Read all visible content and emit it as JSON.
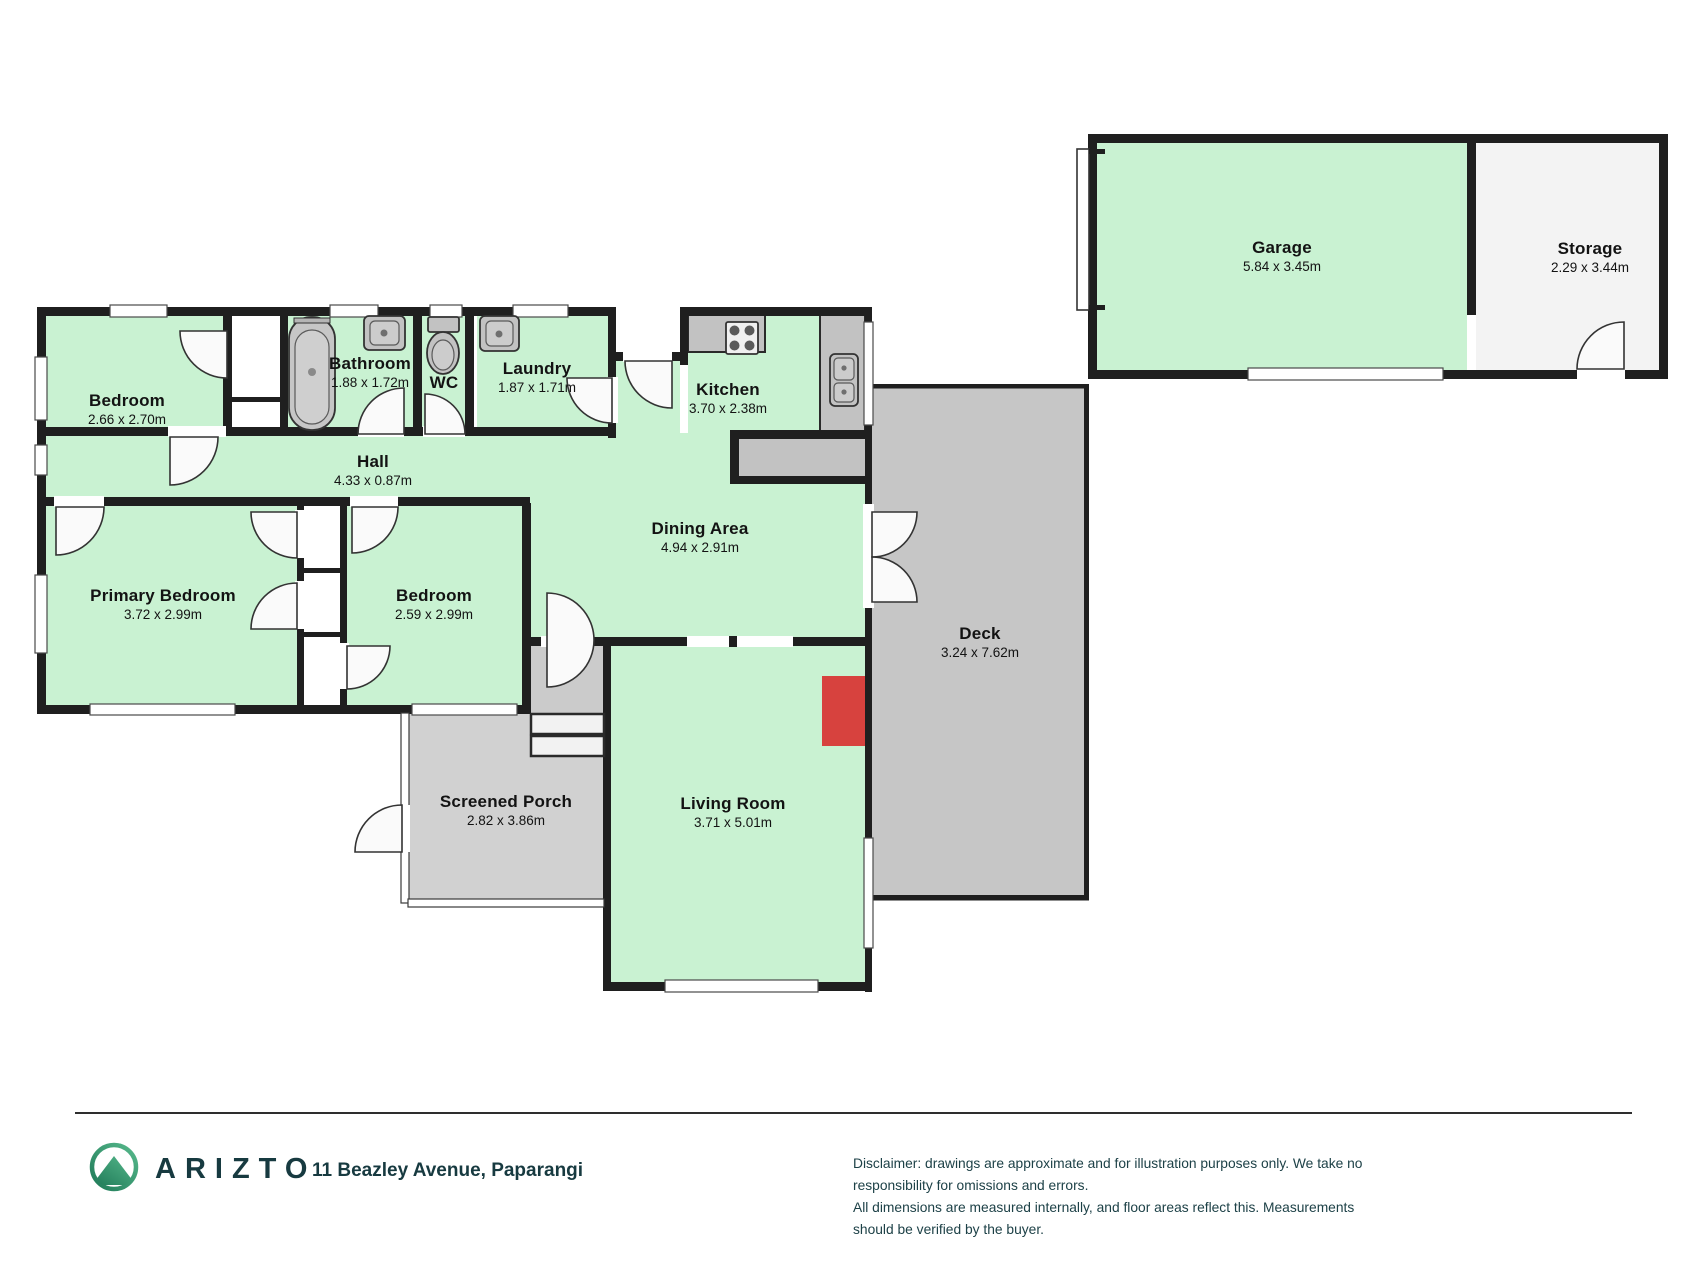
{
  "brand": "ARIZTO",
  "address": "11 Beazley Avenue, Paparangi",
  "disclaimer_line1": "Disclaimer: drawings are approximate and for illustration purposes only. We take no responsibility for omissions and errors.",
  "disclaimer_line2": "All dimensions are measured internally, and floor areas reflect this. Measurements should be verified by the buyer.",
  "colors": {
    "room_green": "#c9f2d2",
    "deck_gray": "#c6c6c6",
    "porch_gray": "#d1d1d1",
    "counter_gray": "#c2c2c2",
    "storage_gray": "#f3f3f3",
    "wall": "#1f1f1f",
    "fireplace_red": "#d7423e",
    "brand_navy": "#173a40",
    "logo_green_light": "#57b98c",
    "logo_green_dark": "#1f7a58"
  },
  "rooms": [
    {
      "id": "bedroom-1",
      "name": "Bedroom",
      "dims": "2.66 x 2.70m"
    },
    {
      "id": "bathroom",
      "name": "Bathroom",
      "dims": "1.88 x 1.72m"
    },
    {
      "id": "wc",
      "name": "WC",
      "dims": ""
    },
    {
      "id": "laundry",
      "name": "Laundry",
      "dims": "1.87 x 1.71m"
    },
    {
      "id": "kitchen",
      "name": "Kitchen",
      "dims": "3.70 x 2.38m"
    },
    {
      "id": "hall",
      "name": "Hall",
      "dims": "4.33 x 0.87m"
    },
    {
      "id": "dining-area",
      "name": "Dining Area",
      "dims": "4.94 x 2.91m"
    },
    {
      "id": "primary-bedroom",
      "name": "Primary Bedroom",
      "dims": "3.72 x 2.99m"
    },
    {
      "id": "bedroom-2",
      "name": "Bedroom",
      "dims": "2.59 x 2.99m"
    },
    {
      "id": "deck",
      "name": "Deck",
      "dims": "3.24 x 7.62m"
    },
    {
      "id": "screened-porch",
      "name": "Screened Porch",
      "dims": "2.82 x 3.86m"
    },
    {
      "id": "living-room",
      "name": "Living Room",
      "dims": "3.71 x 5.01m"
    },
    {
      "id": "garage",
      "name": "Garage",
      "dims": "5.84 x 3.45m"
    },
    {
      "id": "storage",
      "name": "Storage",
      "dims": "2.29 x 3.44m"
    }
  ]
}
